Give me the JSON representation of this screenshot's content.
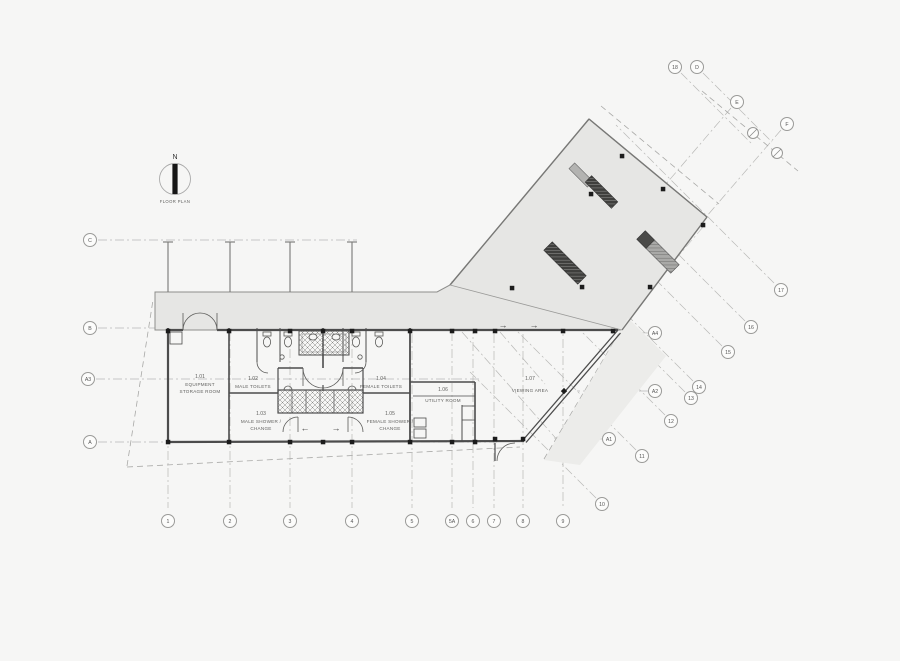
{
  "drawing": {
    "north": {
      "label": "N",
      "caption": "FLOOR PLAN"
    },
    "rooms": {
      "equipment": {
        "number": "1.01",
        "name1": "EQUIPMENT",
        "name2": "STORAGE ROOM"
      },
      "male_toilets": {
        "number": "1.02",
        "name1": "MALE TOILETS"
      },
      "male_shower": {
        "number": "1.03",
        "name1": "MALE SHOWER /",
        "name2": "CHANGE"
      },
      "female_toilets": {
        "number": "1.04",
        "name1": "FEMALE TOILETS"
      },
      "female_shower": {
        "number": "1.05",
        "name1": "FEMALE SHOWER /",
        "name2": "CHANGE"
      },
      "utility": {
        "number": "1.06",
        "name1": "UTILITY ROOM"
      },
      "viewing": {
        "number": "1.07",
        "name1": "VIEWING AREA"
      }
    },
    "grid": {
      "top": [
        {
          "label": "18"
        },
        {
          "label": "D"
        },
        {
          "label": "E"
        },
        {
          "label": "F"
        }
      ],
      "left": [
        {
          "label": "C"
        },
        {
          "label": "B"
        },
        {
          "label": "A3"
        },
        {
          "label": "A"
        }
      ],
      "bottom": [
        {
          "label": "1"
        },
        {
          "label": "2"
        },
        {
          "label": "3"
        },
        {
          "label": "4"
        },
        {
          "label": "5"
        },
        {
          "label": "5A"
        },
        {
          "label": "6"
        },
        {
          "label": "7"
        },
        {
          "label": "8"
        },
        {
          "label": "9"
        }
      ],
      "right": [
        {
          "label": "17"
        },
        {
          "label": "16"
        },
        {
          "label": "15"
        },
        {
          "label": "14"
        },
        {
          "label": "13"
        },
        {
          "label": "12"
        },
        {
          "label": "11"
        },
        {
          "label": "10"
        },
        {
          "label": "A4"
        },
        {
          "label": "A2"
        },
        {
          "label": "A1"
        }
      ]
    },
    "arrows": {
      "left": "←",
      "right": "→"
    },
    "colors": {
      "background": "#f6f6f5",
      "canopy_fill": "#e6e6e4",
      "wedge_fill": "#ececea",
      "wall": "#4c4c4c",
      "gridline": "#b8b8b6",
      "column": "#1c1c1c",
      "bubble_stroke": "#9a9a98"
    }
  }
}
